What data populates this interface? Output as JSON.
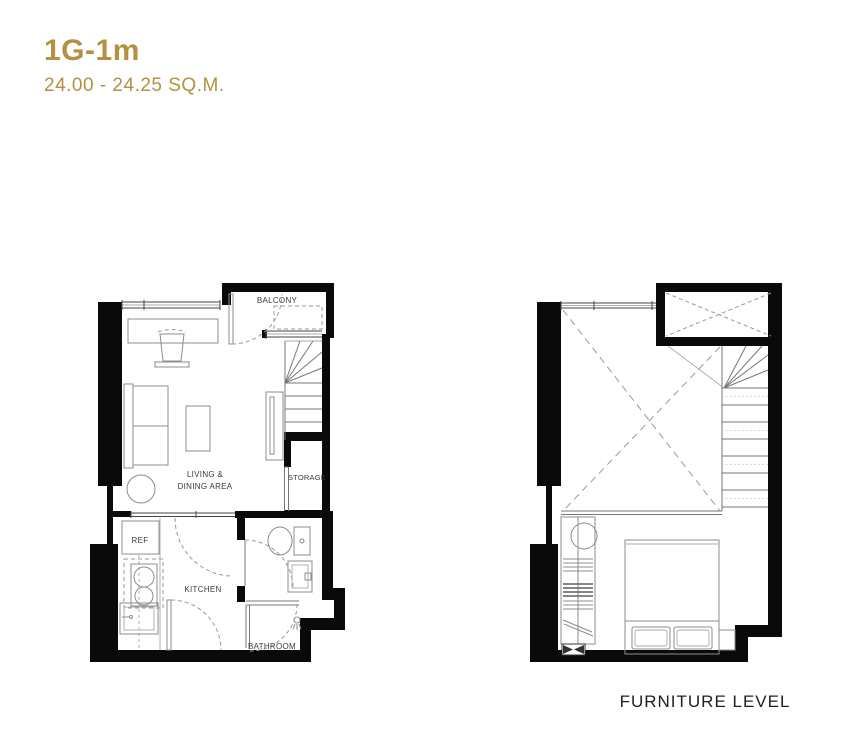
{
  "header": {
    "title": "1G-1m",
    "area_range": "24.00 - 24.25 SQ.M."
  },
  "plans": {
    "main_level": {
      "labels": {
        "balcony": "BALCONY",
        "storage": "STORAGE",
        "living_dining_line1": "LIVING &",
        "living_dining_line2": "DINING AREA",
        "refrigerator": "REF",
        "kitchen": "KITCHEN",
        "bathroom": "BATHROOM"
      }
    },
    "furniture_level": {
      "caption": "FURNITURE LEVEL"
    }
  },
  "colors": {
    "accent_gold": "#B39140",
    "wall_black": "#0A0A0A",
    "furniture_gray": "#8C8C8C",
    "label_dark": "#3A3A3A"
  }
}
